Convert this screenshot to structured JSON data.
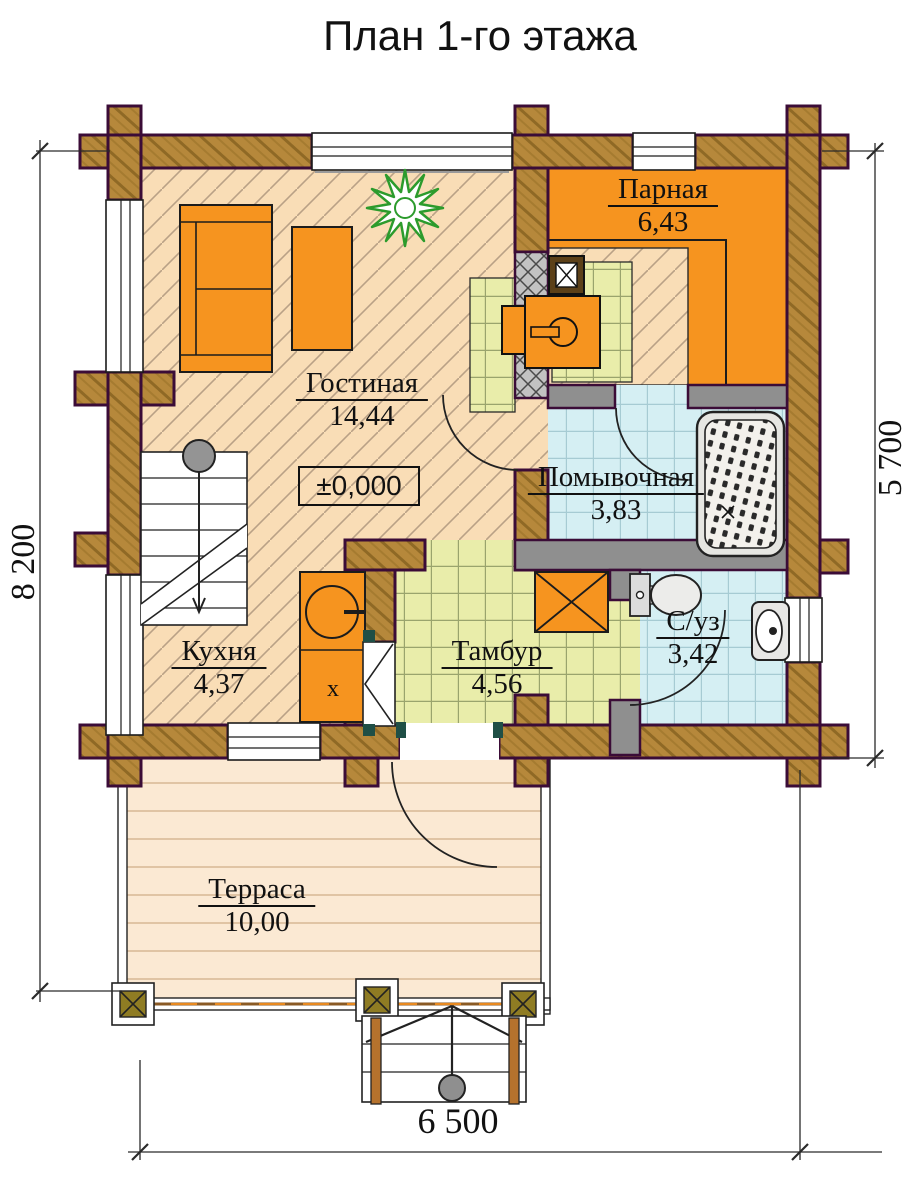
{
  "title": "План 1-го этажа",
  "rooms": [
    {
      "name": "Парная",
      "area": "6,43"
    },
    {
      "name": "Гостиная",
      "area": "14,44"
    },
    {
      "name": "Помывочная",
      "area": "3,83"
    },
    {
      "name": "Кухня",
      "area": "4,37"
    },
    {
      "name": "Тамбур",
      "area": "4,56"
    },
    {
      "name": "С/уз",
      "area": "3,42"
    },
    {
      "name": "Терраса",
      "area": "10,00"
    }
  ],
  "elevation_mark": "±0,000",
  "dimensions": {
    "left": "8 200",
    "right": "5 700",
    "bottom": "6 500"
  },
  "symbols": {
    "stove_mark": "х"
  },
  "colors": {
    "wall_wood": "#b6883b",
    "wall_outline": "#3b0c37",
    "partition_grey": "#8f8f8f",
    "furniture_orange": "#f6941f",
    "sauna_floor": "#f6941f",
    "living_floor": "#f9ddb6",
    "wet_floor": "#d5eff3",
    "tambur_floor": "#e9edaa",
    "terrace_floor": "#fbe9d3",
    "plant_green": "#2c9b2c"
  }
}
